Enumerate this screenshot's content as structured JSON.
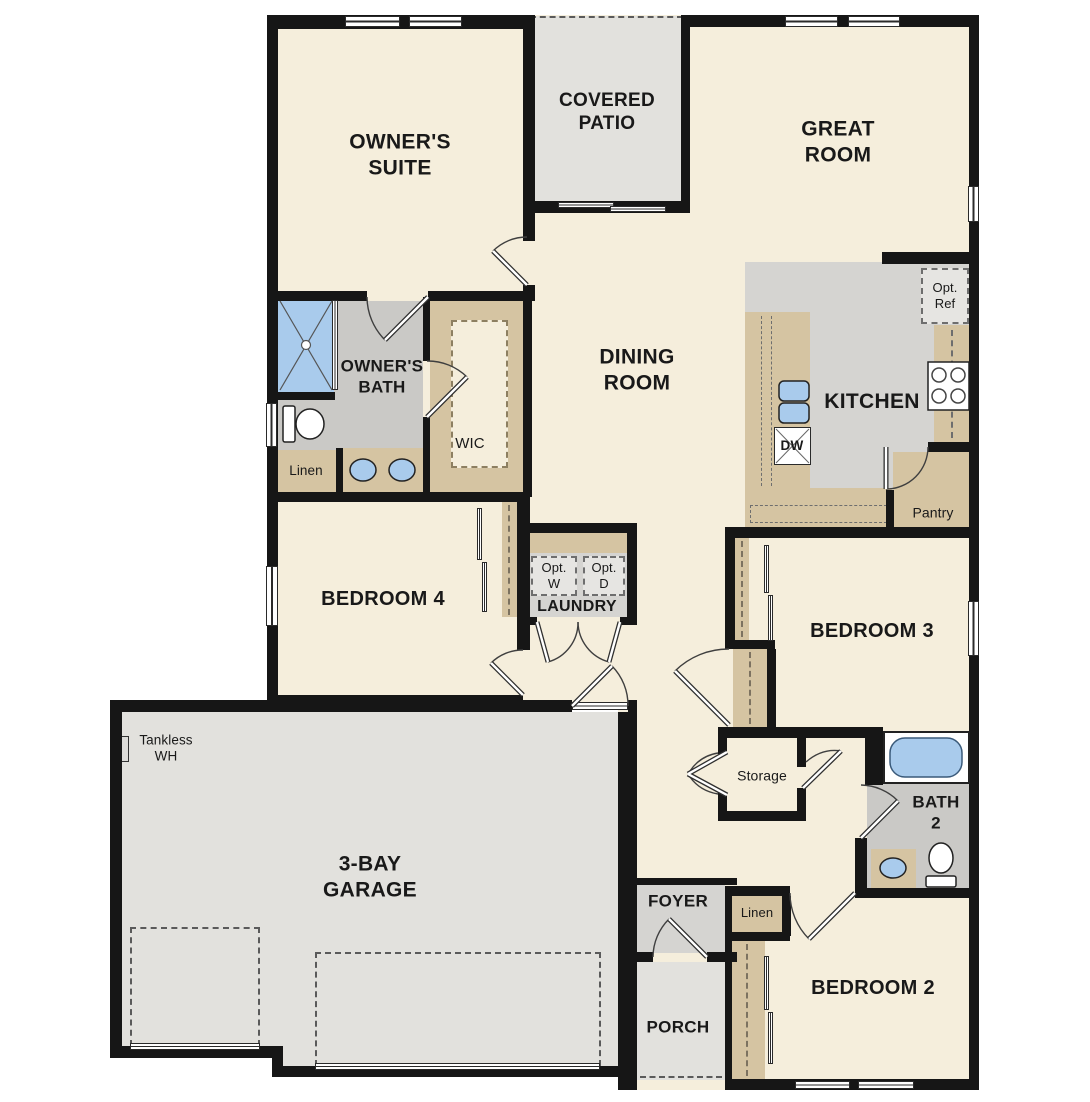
{
  "colors": {
    "wall": "#161616",
    "floor": "#f5eedc",
    "concrete": "#e2e1dd",
    "tile": "#d5d4d1",
    "tile_dark": "#cac9c6",
    "tan": "#d5c4a2",
    "opt_box": "#e6e5e2",
    "fixture_blue": "#a9cbec",
    "dash": "#5a5a5a"
  },
  "rooms": {
    "owners_suite": "OWNER'S\nSUITE",
    "covered_patio": "COVERED\nPATIO",
    "great_room": "GREAT\nROOM",
    "dining_room": "DINING\nROOM",
    "kitchen": "KITCHEN",
    "owners_bath": "OWNER'S\nBATH",
    "wic": "WIC",
    "linen_bath": "Linen",
    "bedroom4": "BEDROOM 4",
    "laundry": "LAUNDRY",
    "pantry": "Pantry",
    "bedroom3": "BEDROOM 3",
    "storage": "Storage",
    "bath2": "BATH\n2",
    "foyer": "FOYER",
    "linen_hall": "Linen",
    "porch": "PORCH",
    "bedroom2": "BEDROOM 2",
    "garage": "3-BAY\nGARAGE"
  },
  "fixtures": {
    "tankless": "Tankless\nWH",
    "opt_washer": "Opt.\nW",
    "opt_dryer": "Opt.\nD",
    "opt_ref": "Opt.\nRef",
    "dishwasher": "DW"
  }
}
